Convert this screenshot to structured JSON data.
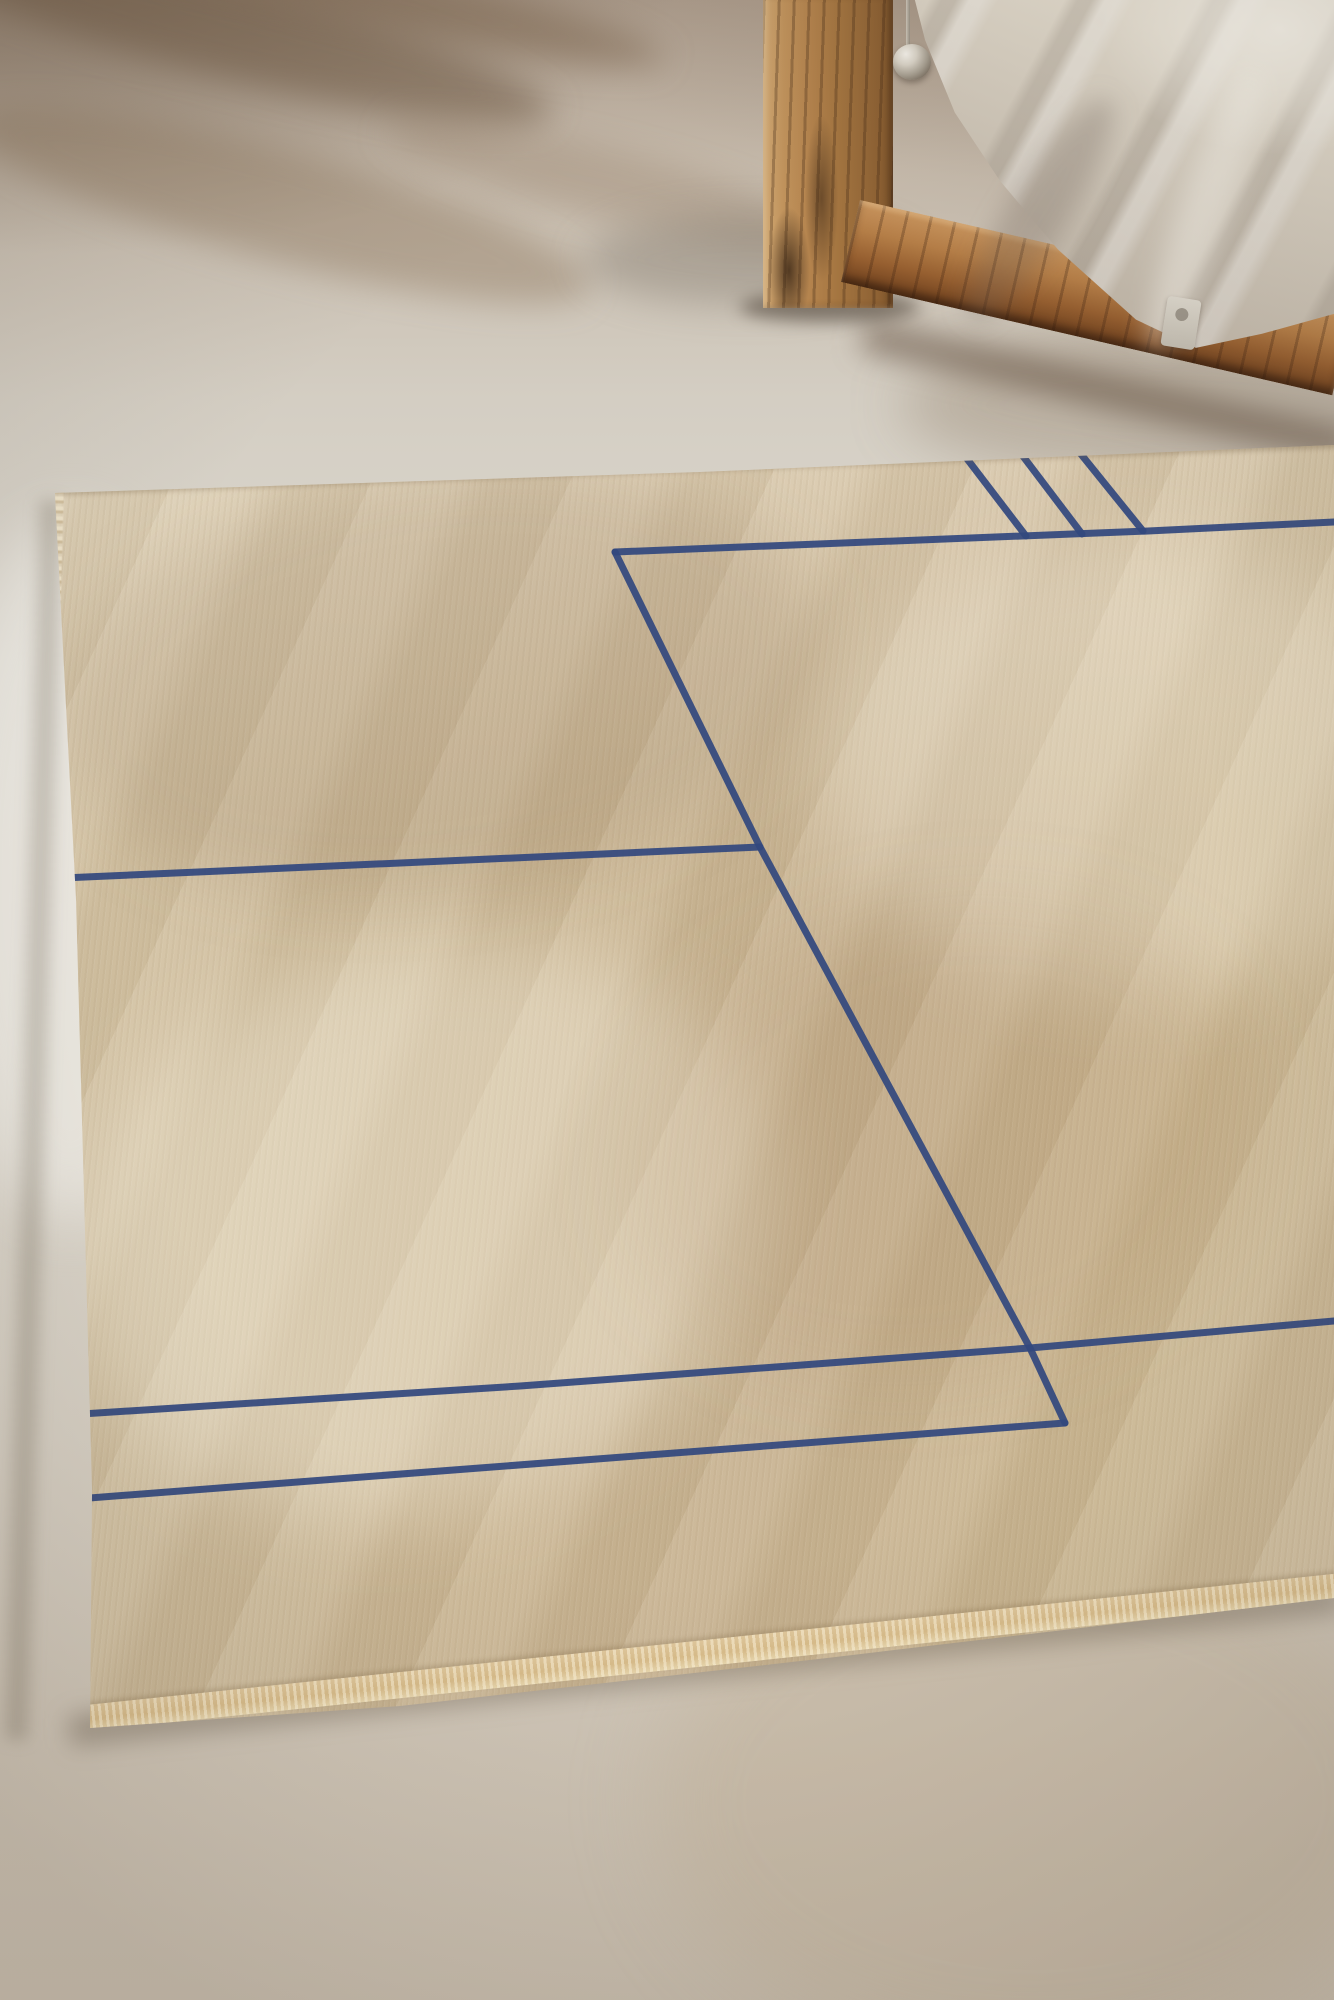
{
  "scene": {
    "description": "Beige hand-woven rug with an indigo geometric line pattern lying on a concrete floor; rustic wooden bed frame with draped linen sheet, chrome lamp knob and fabric care tag in the upper right; soft window-light shadows on the floor.",
    "objects": {
      "floor": "polished concrete floor with diagonal light shadows",
      "rug": "beige wool rug with fringed left edge and stitched bottom binding",
      "pattern": "hand-drawn indigo blue line rectangle with triple stripe accent",
      "bed_post": "vertical rustic wooden post",
      "bed_rail": "diagonal wooden bed rail plank",
      "linen": "draped off-white linen sheet over mattress corner",
      "lamp": "chrome knob finial with thin rod",
      "tag": "fabric care label hanging from linen"
    }
  },
  "palette": {
    "line_blue": "#33487e",
    "rug_base": "#ccb896",
    "rug_highlight": "#dbcbad",
    "rug_binding": "#d8bc8a",
    "fringe": "#f0e5cc",
    "floor_light": "#dcd8cf",
    "floor_shadow": "#70594a",
    "wood_light": "#c1935c",
    "wood_dark": "#6a3f1e",
    "fabric_light": "#efe9dc",
    "fabric_shadow": "#a89d8f",
    "chrome": "#d9d3c7"
  },
  "chart_data": {
    "type": "line",
    "title": "",
    "note": "rug pattern polylines in image pixel coordinates, 1334x2000 frame"
  },
  "rug_pattern": {
    "frame_width": 1334,
    "frame_height": 2000,
    "stroke_width": 7,
    "stroke_opacity": 0.93,
    "lines": [
      {
        "name": "inner-rect-top",
        "points": [
          [
            615,
            552
          ],
          [
            1148,
            531
          ],
          [
            1334,
            522
          ]
        ]
      },
      {
        "name": "inner-rect-right",
        "points": [
          [
            615,
            552
          ],
          [
            760,
            847
          ],
          [
            1030,
            1348
          ],
          [
            1065,
            1423
          ]
        ]
      },
      {
        "name": "inner-rect-bottom",
        "points": [
          [
            50,
            1501
          ],
          [
            1065,
            1423
          ]
        ]
      },
      {
        "name": "mid-left-line",
        "points": [
          [
            40,
            879
          ],
          [
            760,
            847
          ]
        ]
      },
      {
        "name": "lower-long-line",
        "points": [
          [
            50,
            1416
          ],
          [
            520,
            1386
          ],
          [
            1030,
            1348
          ],
          [
            1334,
            1321
          ]
        ]
      },
      {
        "name": "stripe-1",
        "points": [
          [
            958,
            447
          ],
          [
            1026,
            536
          ]
        ]
      },
      {
        "name": "stripe-2",
        "points": [
          [
            1016,
            447
          ],
          [
            1082,
            534
          ]
        ]
      },
      {
        "name": "stripe-3",
        "points": [
          [
            1076,
            448
          ],
          [
            1143,
            531
          ]
        ]
      }
    ]
  }
}
